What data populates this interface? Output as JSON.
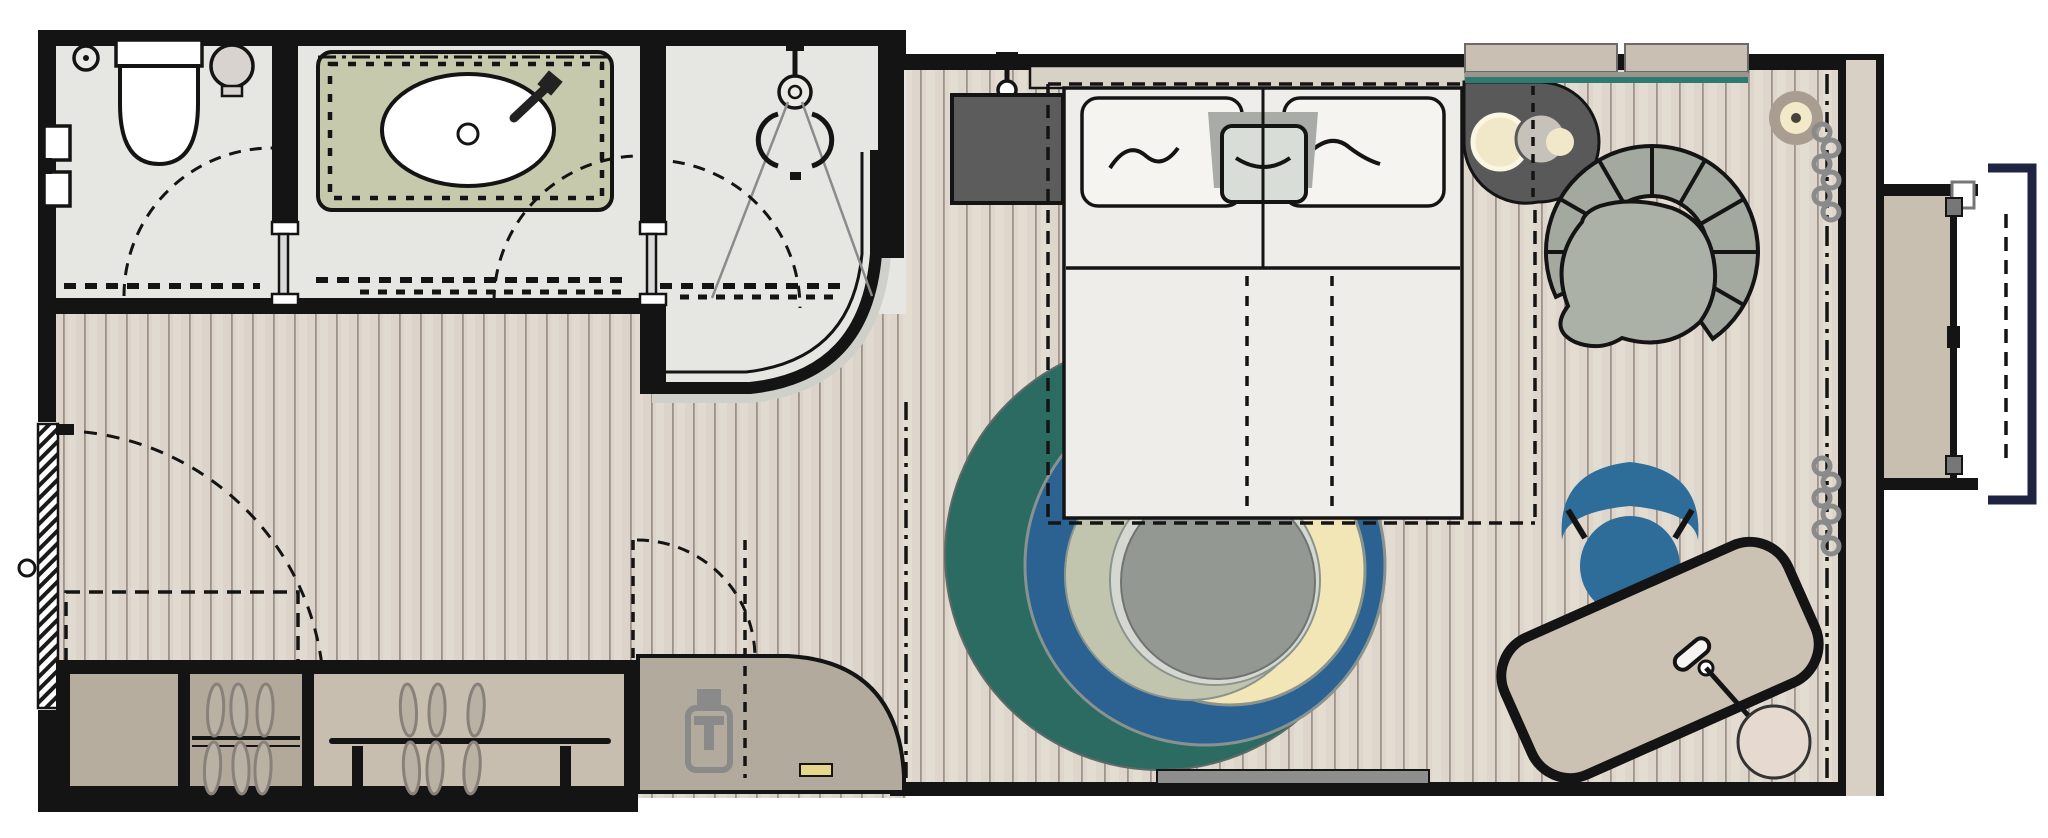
{
  "title": "hotel-room-floor-plan",
  "palette": {
    "wall": "#141414",
    "bath_floor": "#e6e7e3",
    "plank_base": "#ddd5cb",
    "plank_line": "#9c9287",
    "plank_light": "#e5ded4",
    "counter_olive": "#c7c9ad",
    "cabinet_tan_dark": "#b6ad9f",
    "cabinet_tan": "#b2a99b",
    "bench_tan": "#c7beaf",
    "minibar_gray": "#b2aa9d",
    "threshold_gray": "#d0d0cb",
    "tv_dark": "#5c5c5c",
    "bed_mattress": "#efedea",
    "headboard": "#d8d1c6",
    "pillow": "#f6f4f1",
    "bolster_wrap": "#a9aba7",
    "bolster": "#d8ddd7",
    "side_table_dark": "#59595a",
    "lamp_cream": "#f1e8ca",
    "lamp_gray": "#c6c2ba",
    "console_tan": "#c9c0b3",
    "console_teal_edge": "#2f7a70",
    "floor_lamp_ring": "#a89d90",
    "armchair": "#a3a99e",
    "rug_teal": "#2c6b62",
    "rug_blue": "#2c6291",
    "rug_cream": "#f3e6b6",
    "rug_olive": "#c2c5ae",
    "rug_pale": "#d5d8d0",
    "rug_center": "#939893",
    "desk_tan": "#cbc2b3",
    "chair_blue": "#2e6d99",
    "balcony_platform": "#c8bfb0",
    "balcony_navy": "#1d2340",
    "curtain_gray": "#8a8a8a",
    "accent_yellow": "#e7d78a",
    "hanger": "#b9b1a4"
  },
  "rooms": {
    "wc": {
      "label": "WC with toilet, floor drain and hand basin"
    },
    "vanity": {
      "label": "Vanity room with washbasin counter"
    },
    "shower": {
      "label": "Shower room with curved glass wall"
    },
    "hallway": {
      "label": "Entry hallway with wardrobe and minibar"
    },
    "bedroom": {
      "label": "Bedroom with double bed, rug, desk and armchair"
    },
    "balcony": {
      "label": "French balcony with fold-down platform"
    }
  },
  "furniture": {
    "toilet": "toilet",
    "floor_drain": "floor drain",
    "hand_basin": "hand basin",
    "vanity_sink": "oval washbasin with mixer tap",
    "shower_head": "rain shower head",
    "entry_door": "entry door with swing arc",
    "wardrobe": "wardrobe with six hangers and bench rail",
    "minibar": "minibar cabinet with kettle",
    "tv": "wall-mounted TV panel",
    "bed": "double bed with two pillows and bolster",
    "bedside_table": "dark bedside table with two lamps",
    "console_shelf": "wall console shelf with teal edge",
    "floor_lamp": "round floor lamp",
    "armchair": "segmented fan armchair",
    "rug": "round rug with offset colour rings",
    "desk": "rotated writing desk with lamp",
    "desk_chair": "blue desk chair",
    "sideboard_strip": "low wall bench strip",
    "curtains": "curtain bunches at window line",
    "balcony_rail": "balcony railing"
  }
}
